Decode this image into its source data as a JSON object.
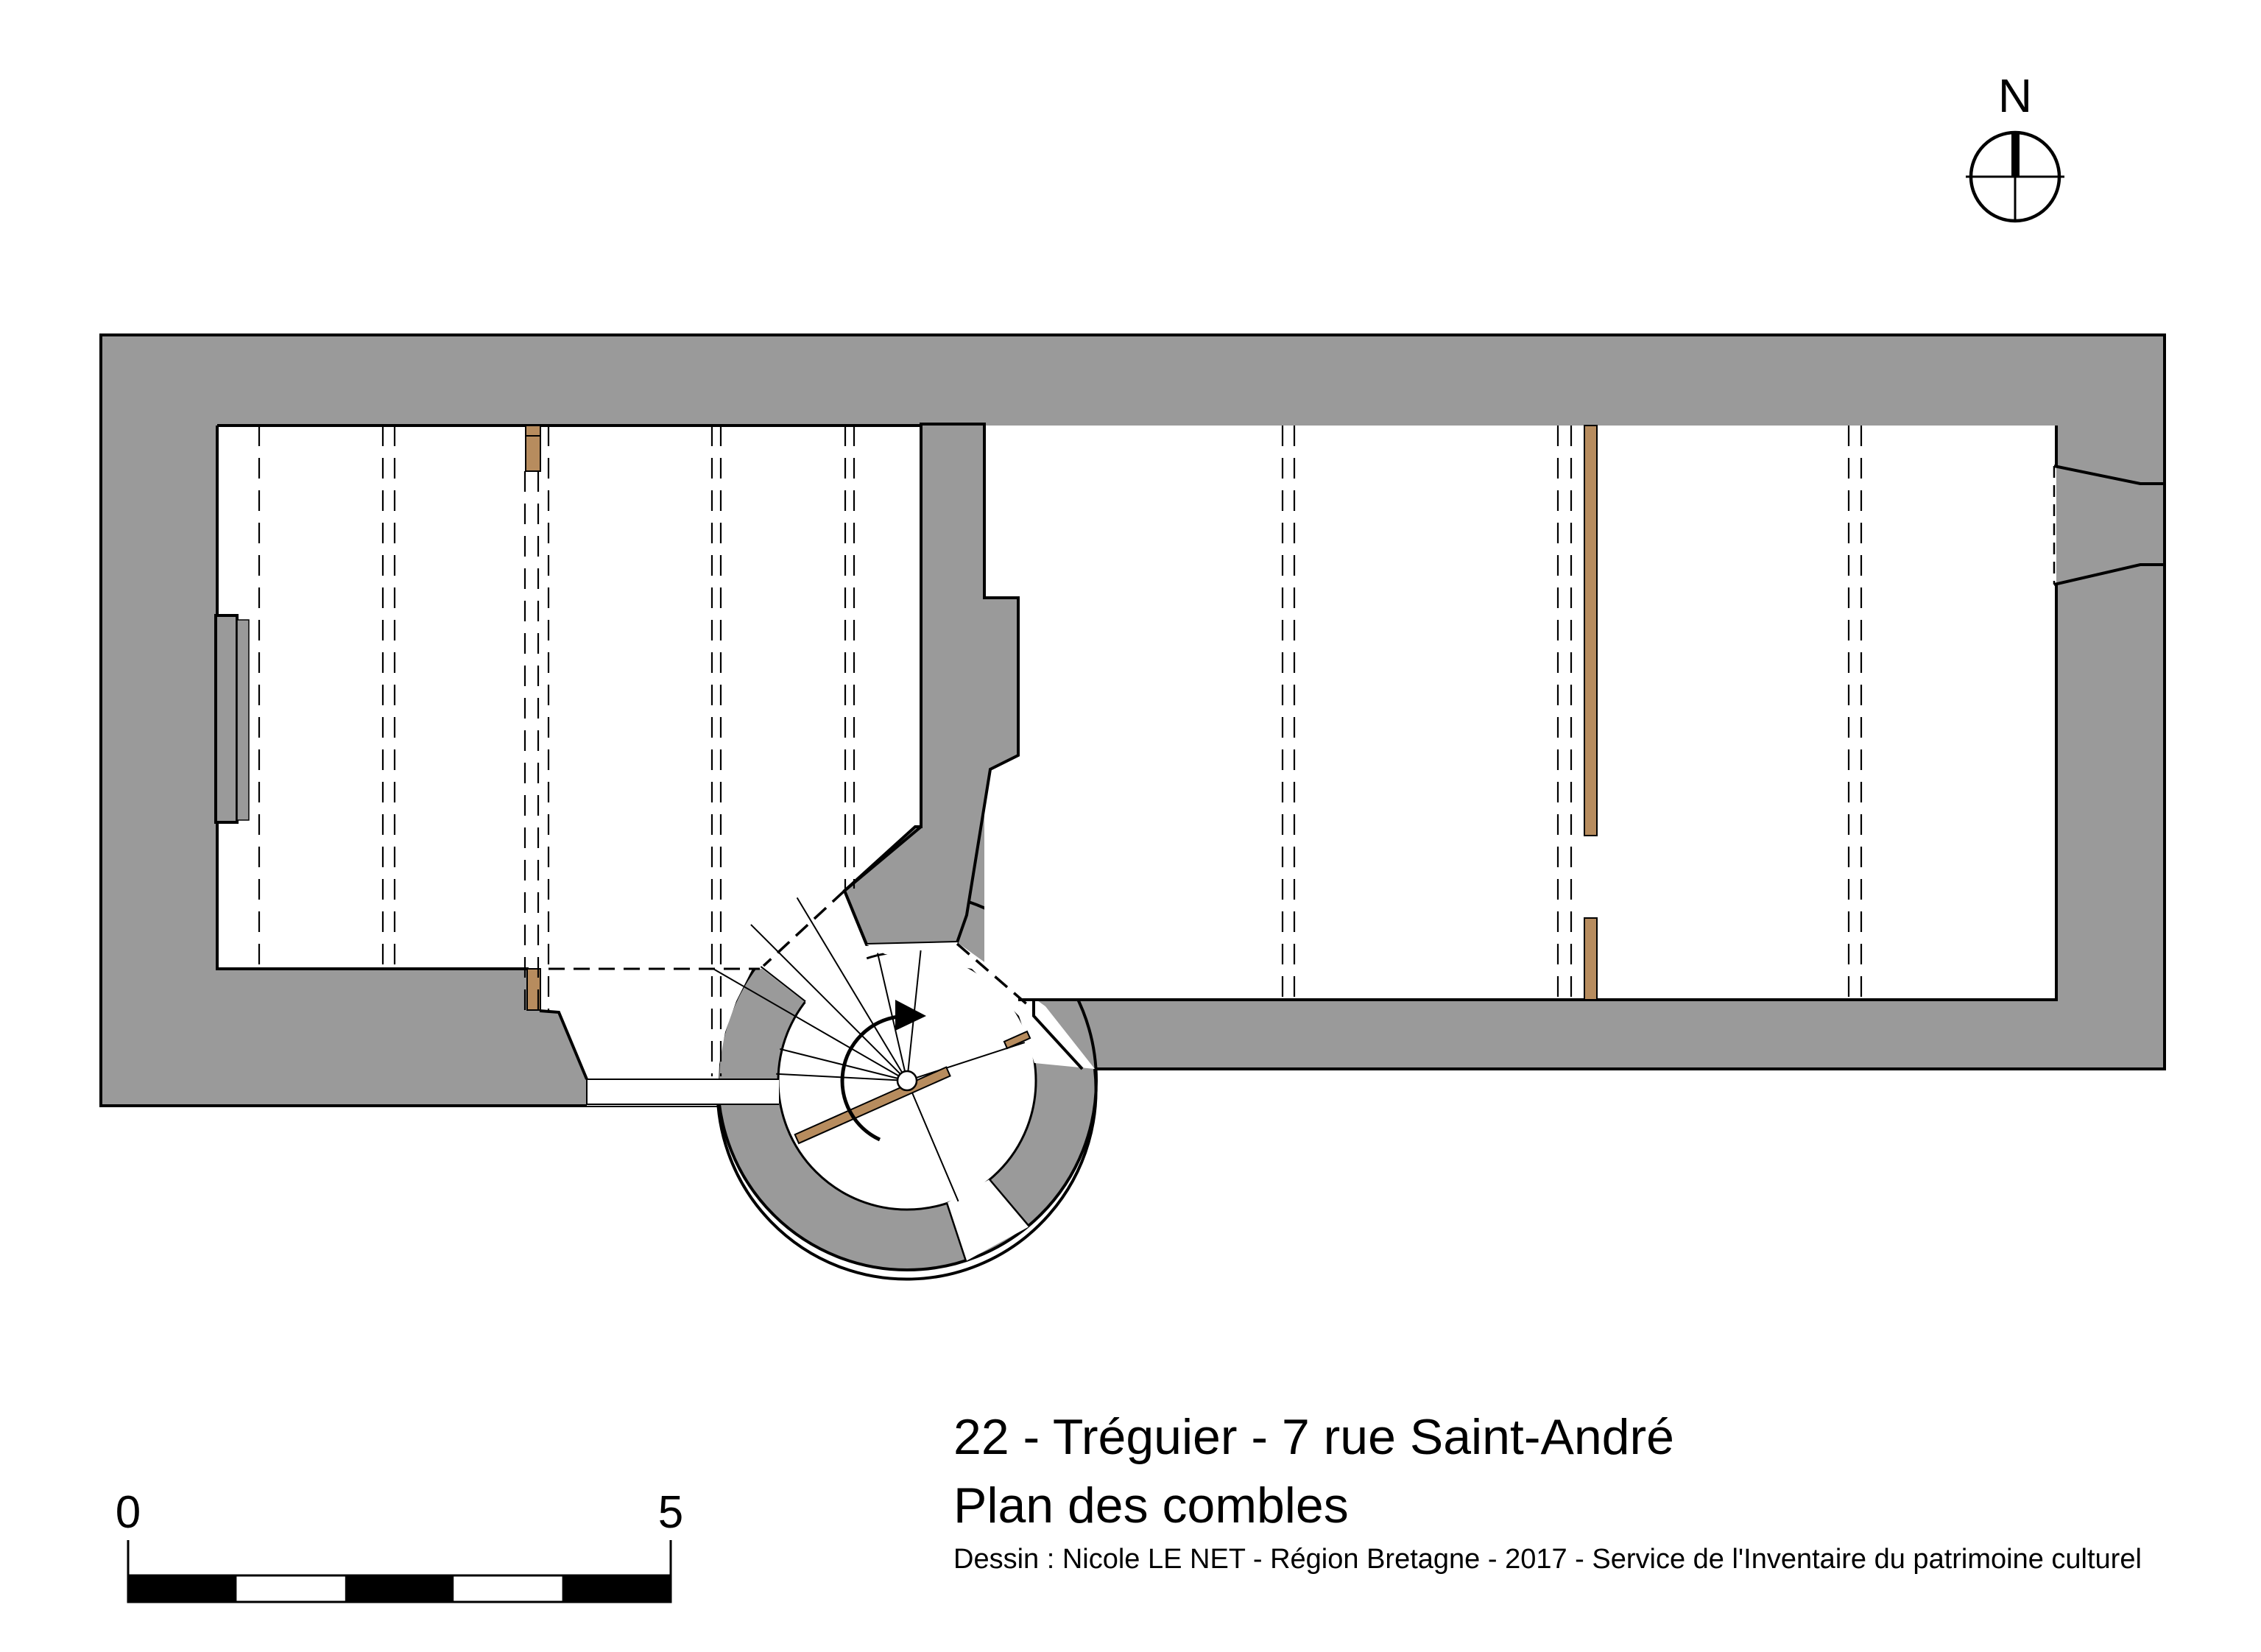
{
  "title_block": {
    "line1": "22 - Tréguier - 7 rue Saint-André",
    "line2": "Plan des combles",
    "credit": "Dessin : Nicole LE NET - Région Bretagne - 2017 - Service de l'Inventaire du patrimoine culturel"
  },
  "compass": {
    "label": "N"
  },
  "scale_bar": {
    "start_label": "0",
    "end_label": "5",
    "segments": 5
  },
  "colors": {
    "wall_fill": "#9a9a9a",
    "outline": "#000000",
    "wood": "#b78c5e",
    "background": "#ffffff"
  }
}
